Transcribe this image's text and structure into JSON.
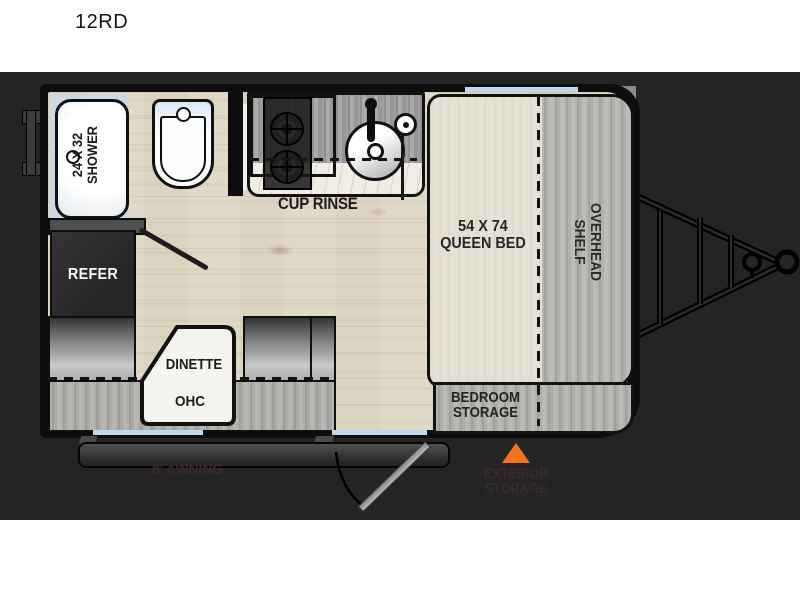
{
  "title": "12RD",
  "colors": {
    "accent_orange": "#F4731F",
    "window_blue": "#BDD9F2",
    "panel_bg": "#242424",
    "wall_black": "#0D0D0D",
    "floor_wood": "#E1D9C7"
  },
  "floorplan": {
    "shower": {
      "line1": "24 X 32",
      "line2": "SHOWER"
    },
    "cup_rinse": "CUP RINSE",
    "queen_bed": {
      "line1": "54 X 74",
      "line2": "QUEEN BED"
    },
    "overhead_shelf": {
      "line1": "OVERHEAD",
      "line2": "SHELF"
    },
    "refer": "REFER",
    "dinette": "DINETTE",
    "ohc": "OHC",
    "bedroom_storage": {
      "line1": "BEDROOM",
      "line2": "STORAGE"
    },
    "awning": "8' AWNING",
    "exterior_storage": {
      "line1": "EXTERIOR",
      "line2": "STORAGE"
    }
  }
}
